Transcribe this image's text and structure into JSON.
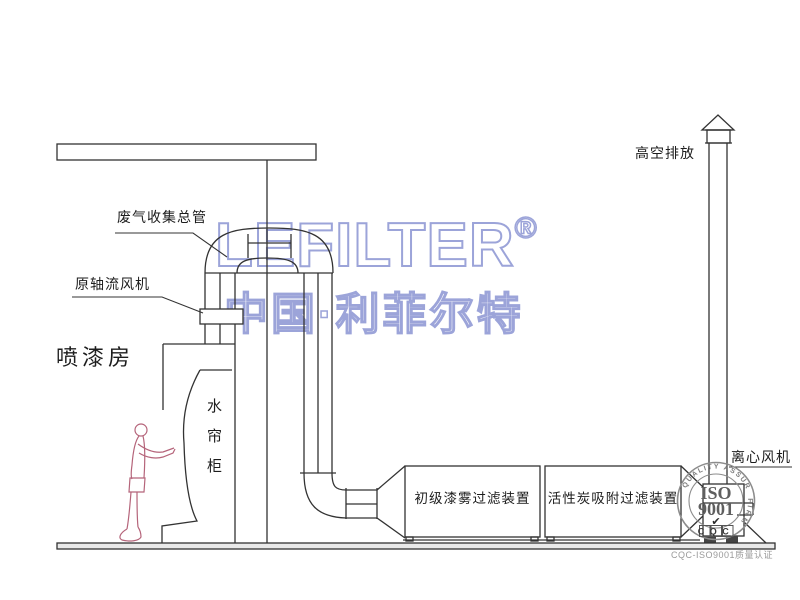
{
  "diagram": {
    "labels": {
      "waste_gas_main": "废气收集总管",
      "axial_fan": "原轴流风机",
      "spray_room": "喷漆房",
      "water_curtain_cabinet": "水帘柜",
      "high_discharge": "高空排放",
      "primary_filter": "初级漆雾过滤装置",
      "carbon_filter": "活性炭吸附过滤装置",
      "centrifugal_fan": "离心风机"
    },
    "watermark": {
      "brand": "LEFILTER",
      "registered": "®",
      "brand_cn": "中国·利菲尔特",
      "color": "#9ca4d9"
    },
    "seal": {
      "arc_top": "QUALITY ASSURED",
      "arc_right": "FIRM",
      "line1": "ISO",
      "line2": "9001",
      "check_icon": "✔",
      "bottom": "CQC",
      "caption": "CQC-ISO9001质量认证"
    },
    "colors": {
      "line": "#333333",
      "person": "#b5647a",
      "seal_gray": "#8c8c8c",
      "watermark": "#9ca4d9"
    }
  }
}
